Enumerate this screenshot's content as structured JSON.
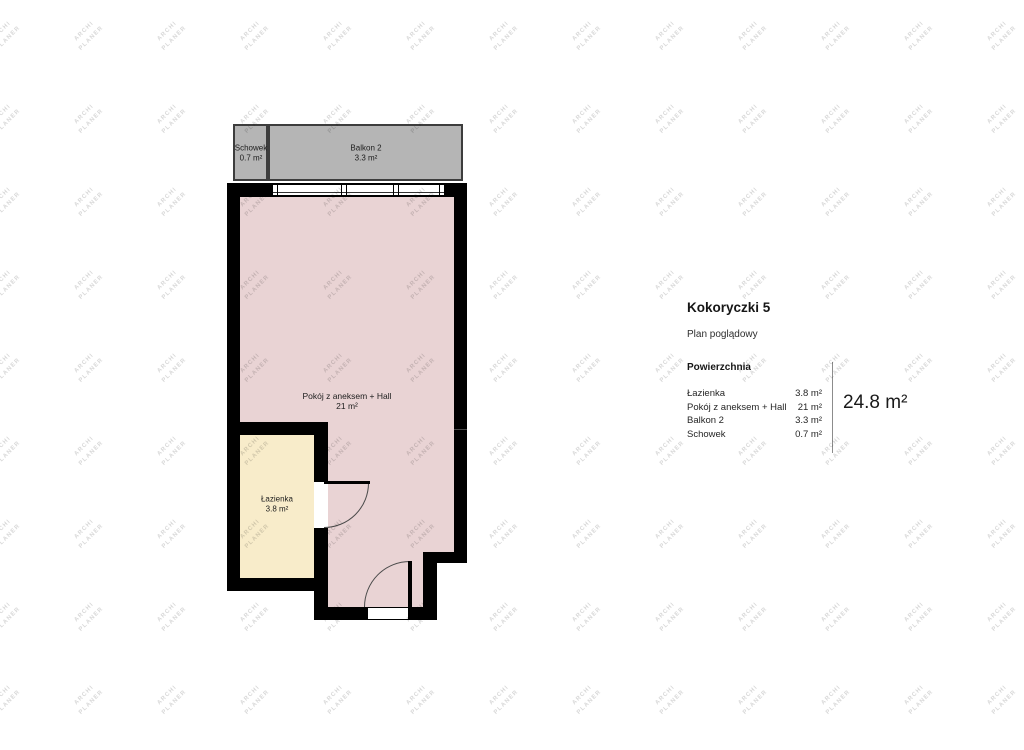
{
  "plan": {
    "rooms": {
      "schowek": {
        "name": "Schowek",
        "area": "0.7 m²"
      },
      "balkon": {
        "name": "Balkon 2",
        "area": "3.3 m²"
      },
      "pokoj": {
        "name": "Pokój z aneksem + Hall",
        "area": "21 m²"
      },
      "lazienka": {
        "name": "Łazienka",
        "area": "3.8 m²"
      }
    }
  },
  "legend": {
    "title": "Kokoryczki 5",
    "subtitle": "Plan poglądowy",
    "section_header": "Powierzchnia",
    "rows": [
      {
        "label": "Łazienka",
        "value": "3.8 m²"
      },
      {
        "label": "Pokój z aneksem + Hall",
        "value": "21 m²"
      },
      {
        "label": "Balkon 2",
        "value": "3.3 m²"
      },
      {
        "label": "Schowek",
        "value": "0.7 m²"
      }
    ],
    "total": "24.8 m²"
  },
  "watermark": {
    "line1": "ARCHI",
    "line2": "PLANER"
  },
  "colors": {
    "wall": "#000000",
    "room_pink": "#e9d3d4",
    "bathroom_cream": "#f8ecca",
    "balcony_gray": "#b5b5b5",
    "balcony_border": "#3d3d3d",
    "watermark_gray": "#d8d8d8",
    "line_gray": "#8c8c8c",
    "text_dark": "#1f1f1f"
  }
}
